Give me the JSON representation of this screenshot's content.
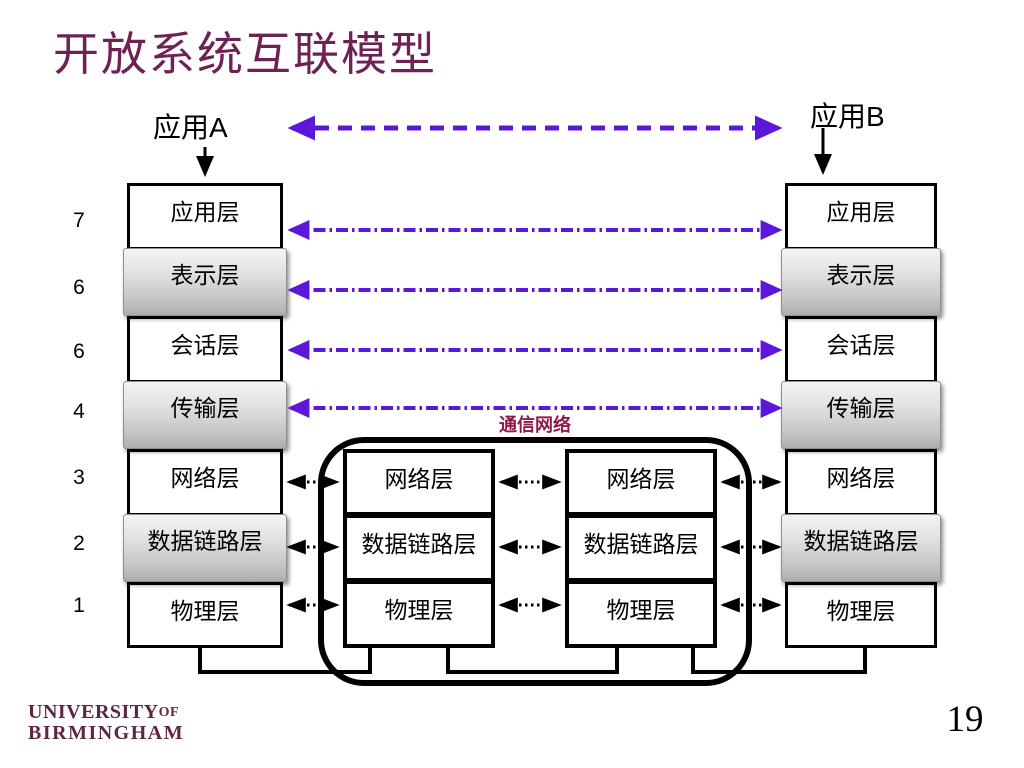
{
  "slide": {
    "title": "开放系统互联模型",
    "page_number": "19",
    "logo": {
      "line1": "UNIVERSITY",
      "line1_suffix": "OF",
      "line2": "BIRMINGHAM"
    }
  },
  "diagram": {
    "endpoint_a": "应用A",
    "endpoint_b": "应用B",
    "network_label": "通信网络",
    "layer_numbers": [
      "7",
      "6",
      "6",
      "4",
      "3",
      "2",
      "1"
    ],
    "layers": [
      "应用层",
      "表示层",
      "会话层",
      "传输层",
      "网络层",
      "数据链路层",
      "物理层"
    ],
    "relay_layers": [
      "网络层",
      "数据链路层",
      "物理层"
    ],
    "colors": {
      "title_text": "#6E2155",
      "peer_arrow_purple": "#5D17D9",
      "network_label_text": "#8C1A4B",
      "logo_text": "#5E2545",
      "box_border": "#000000",
      "gray_layer_top": "#f4f4f4",
      "gray_layer_bottom": "#adadad"
    }
  }
}
